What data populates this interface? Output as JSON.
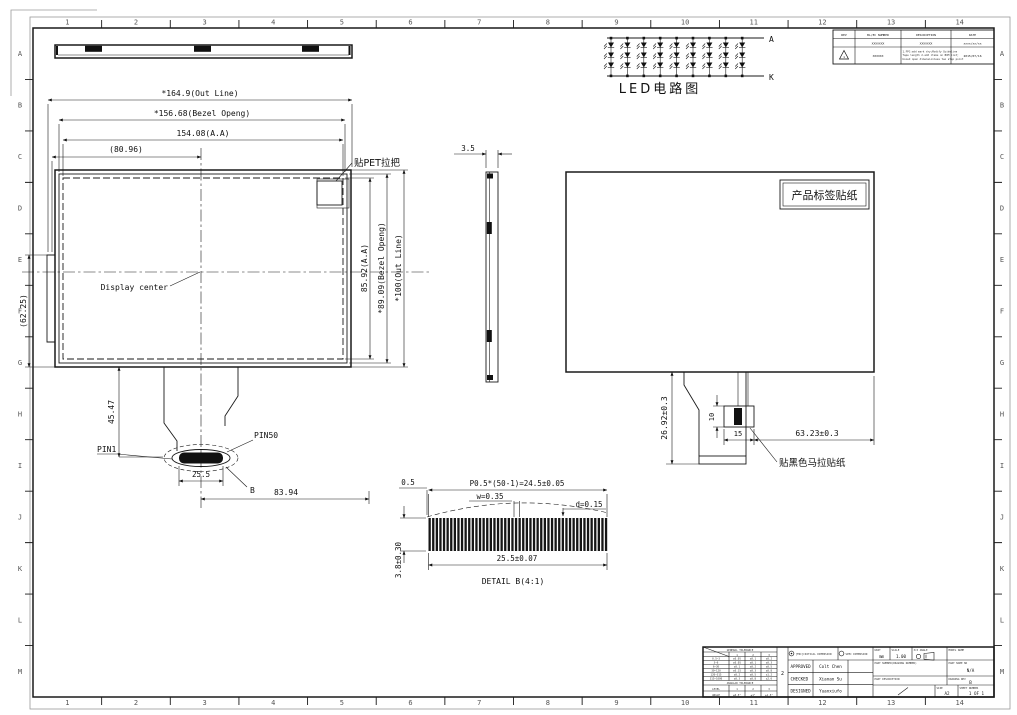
{
  "sheet": {
    "grid": {
      "cols": [
        "1",
        "2",
        "3",
        "4",
        "5",
        "6",
        "7",
        "8",
        "9",
        "10",
        "11",
        "12",
        "13",
        "14"
      ],
      "rows": [
        "A",
        "B",
        "C",
        "D",
        "E",
        "F",
        "G",
        "H",
        "I",
        "J",
        "K",
        "L",
        "M"
      ]
    }
  },
  "front": {
    "out_w": "*164.9(Out Line)",
    "bezel_w": "*156.68(Bezel Openg)",
    "aa_w": "154.08(A.A)",
    "center_x": "(80.96)",
    "out_h": "*100(Out Line)",
    "bezel_h": "*89.09(Bezel Openg)",
    "aa_h": "85.92(A.A)",
    "left_h": "(62.25)",
    "pet_label": "贴PET拉把",
    "display_center": "Display center",
    "fpc_len": "45.47",
    "pin1": "PIN1",
    "pin50": "PIN50",
    "conn_w": "25.5",
    "detail_mark": "B",
    "conn_x": "83.94"
  },
  "side": {
    "thickness": "3.5"
  },
  "back": {
    "sticker": "产品标签贴纸",
    "fpc_len": "26.92±0.3",
    "tape_h": "10",
    "tape_w": "15",
    "tape_x": "63.23±0.3",
    "mylar": "贴黑色马拉贴纸"
  },
  "led": {
    "title": "LED电路图",
    "anode": "A",
    "cathode": "K",
    "columns": 9,
    "leds_per_column": 3
  },
  "detail_b": {
    "title": "DETAIL B(4:1)",
    "offset": "0.5",
    "pitch": "P0.5*(50-1)=24.5±0.05",
    "tooth_w": "w=0.35",
    "tooth_d": "d=0.15",
    "width": "25.5±0.07",
    "height": "3.8±0.30",
    "teeth": 50
  },
  "revision_table": {
    "headers": [
      "REV",
      "BL/EC NUMBER",
      "DESCRIPTION",
      "DATE"
    ],
    "rows": [
      {
        "rev": "",
        "number": "XXXXXXX",
        "description": "XXXXXXX",
        "date": "xxxx/xx/xx"
      },
      {
        "rev": "1",
        "number": "XXXXXX",
        "desc_lines": [
          "1.FPC:add mark dry;Modify Guideline",
          "Tape length 2.add items on BOM list;",
          "boxed open dimensionless two step point"
        ],
        "date": "2015/07/16"
      }
    ]
  },
  "title_block": {
    "tolerance": {
      "general_header": "GENERAL TOLERANCE",
      "level_headers": [
        "",
        "1",
        "2",
        "3"
      ],
      "rows": [
        [
          "0.5~3",
          "±0.05",
          "±0.1",
          "±0.2"
        ],
        [
          "3~6",
          "±0.05",
          "±0.1",
          "±0.3"
        ],
        [
          "6~30",
          "±0.1",
          "±0.2",
          "±0.5"
        ],
        [
          "30~120",
          "±0.15",
          "±0.3",
          "±0.8"
        ],
        [
          "120~315",
          "±0.2",
          "±0.5",
          "±1.2"
        ],
        [
          "315~1000",
          "±0.3",
          "±0.8",
          "±2.0"
        ]
      ],
      "angular_header": "ANGULAR TOLERANCE",
      "level_row": [
        "LEVEL",
        "1",
        "2",
        "3"
      ],
      "angle_row": [
        "ANGLE",
        "±0.5°",
        "±1°",
        "±1.5°"
      ],
      "selected_level": "2"
    },
    "critical_label": "[FNC]CRITICAL DIMENSION",
    "spec_label": "SPEC DIMENSION",
    "approvals": [
      {
        "role": "APPROVED",
        "name": "Colt Chen"
      },
      {
        "role": "CHECKED",
        "name": "Xianan Su"
      },
      {
        "role": "DESIGNED",
        "name": "Yuanxiufo"
      }
    ],
    "unit_label": "UNIT",
    "unit": "mm",
    "scale_label": "SCALE",
    "scale": "1.00",
    "angle_label": "3rd ANGLE",
    "model_label": "MODEL NAME",
    "part_number_label": "PART NUMBER(DRAWING NUMBER)",
    "part_name_label": "PART NAME NO",
    "part_name": "N/A",
    "part_desc_label": "PART DESCRIPTION",
    "rev_label": "DRAWING REV",
    "rev": "B",
    "size_label": "SIZE",
    "size": "A2",
    "sheet_label": "SHEET NUMBER",
    "sheet": "1 OF 1"
  }
}
